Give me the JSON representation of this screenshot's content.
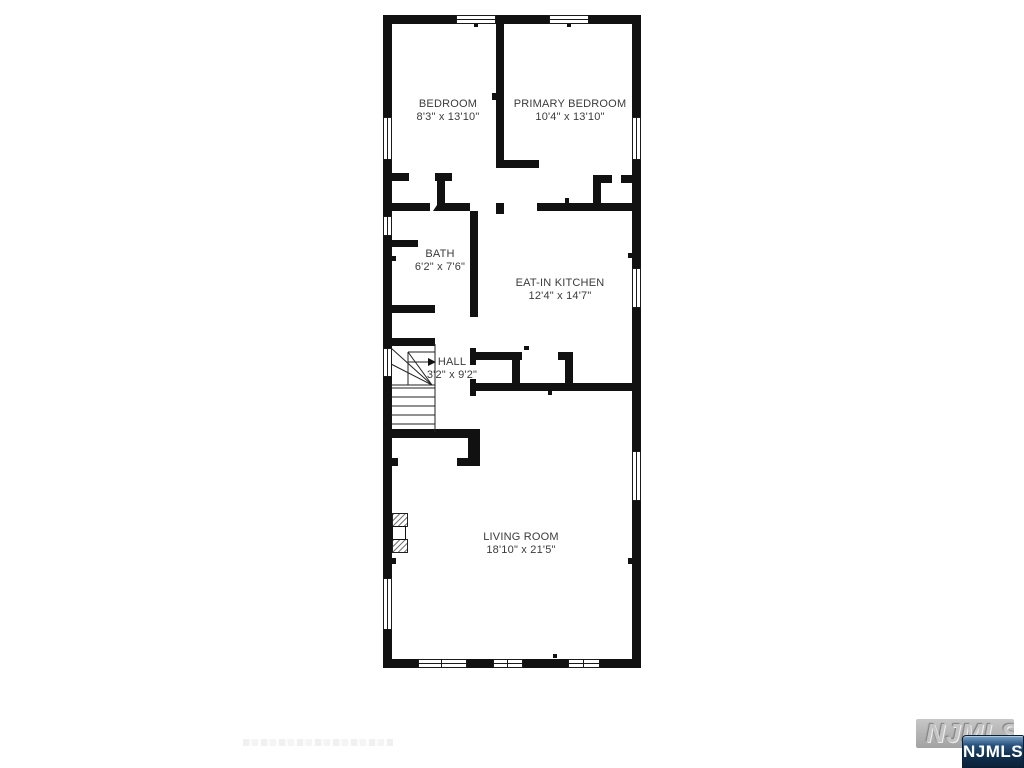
{
  "plan": {
    "title": "floor-plan",
    "rooms": [
      {
        "name": "BEDROOM",
        "dims": "8'3\" x 13'10\""
      },
      {
        "name": "PRIMARY BEDROOM",
        "dims": "10'4\" x 13'10\""
      },
      {
        "name": "BATH",
        "dims": "6'2\" x 7'6\""
      },
      {
        "name": "EAT-IN KITCHEN",
        "dims": "12'4\" x 14'7\""
      },
      {
        "name": "HALL",
        "dims": "3'2\" x 9'2\""
      },
      {
        "name": "LIVING ROOM",
        "dims": "18'10\" x 21'5\""
      }
    ],
    "colors": {
      "wall": "#111111",
      "background": "#ffffff",
      "label": "#3b3b3b"
    }
  },
  "watermark": {
    "logo_text": "NJMLS",
    "badge_text": "NJMLS",
    "badge_color": "#16324f"
  }
}
